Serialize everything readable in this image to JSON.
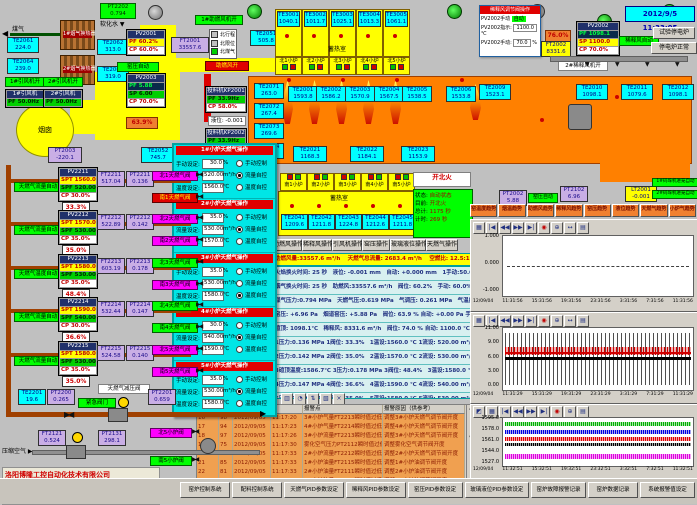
{
  "header": {
    "datetime": "2012/9/5 11:33:05"
  },
  "left": {
    "coal_gas": "煤气",
    "soft_water": "软化水",
    "chimney": "烟囱",
    "comb_air_on": "助燃风开",
    "fan1_on": "1#引风机开",
    "fan2_on": "2#引风机开",
    "comb_fan_on": "1#助燃风机开",
    "dilution_fan_on": "2#稀释风机开",
    "hx": [
      "1#烟气换热器",
      "2#烟气换热器"
    ],
    "legend": [
      "北行程",
      "北限位",
      "北煤气"
    ],
    "boxes": {
      "pt2202": {
        "id": "PT2202",
        "v": "0.794"
      },
      "te2061": {
        "id": "TE2061",
        "v": "224.0"
      },
      "te2064": {
        "id": "TE2064",
        "v": "239.0"
      },
      "te2062": {
        "id": "TE2062",
        "v": "313.0"
      },
      "te2063": {
        "id": "TE2063",
        "v": "319.0"
      },
      "pt2003": {
        "id": "PT2003",
        "v": "-220.1"
      },
      "te2052": {
        "id": "TE2052",
        "v": "745.7"
      },
      "ft2001": {
        "id": "FT2001",
        "v": "33557.6"
      },
      "te2051": {
        "id": "TE2051",
        "v": "505.8"
      }
    },
    "fans": [
      {
        "label": "1#引风机",
        "pf": "PF 50.0Hz"
      },
      {
        "label": "2#引风机",
        "pf": "PF 50.0Hz"
      }
    ],
    "pv2001": {
      "id": "PV2001",
      "pf": "PF 60.2%",
      "cp": "CP 60.0%"
    },
    "pv2003": {
      "id": "PV2003",
      "pf": "PF 5.88",
      "sp": "SP 6.00",
      "cp": "CP 70.0%"
    },
    "kiln_auto": "窑压自动",
    "damper_pos": "63.9%",
    "chargers": [
      {
        "title": "投料机KP2001",
        "pf": "PF 33.9Hz",
        "cp": "CP 58.0%"
      },
      {
        "title": "投料机KP2002",
        "pf": "PF 33.9Hz",
        "cp": "CP 58.0%"
      }
    ],
    "level_box": "液位: -0.001"
  },
  "regen": {
    "room": "蓄热室",
    "units": [
      {
        "id": "TE3001",
        "v": "1040.1",
        "port": "北1小炉"
      },
      {
        "id": "TE3002",
        "v": "1011.7",
        "port": "北2小炉"
      },
      {
        "id": "TE3003",
        "v": "1025.1",
        "port": "北3小炉"
      },
      {
        "id": "TE3004",
        "v": "1013.3",
        "port": "北4小炉"
      },
      {
        "id": "TE3005",
        "v": "1061.1",
        "port": "北5小炉"
      }
    ]
  },
  "furnace": {
    "left_te": [
      {
        "id": "TE2071",
        "v": "263.0"
      },
      {
        "id": "TE2072",
        "v": "267.4"
      },
      {
        "id": "TE2073",
        "v": "269.6"
      },
      {
        "id": "TE2074",
        "v": "268.6"
      }
    ],
    "top_te": [
      {
        "id": "TE2001",
        "v": "1593.8"
      },
      {
        "id": "TE2002",
        "v": "1586.2"
      },
      {
        "id": "TE2003",
        "v": "1570.9"
      },
      {
        "id": "TE2004",
        "v": "1567.5"
      },
      {
        "id": "TE2005",
        "v": "1538.5"
      },
      {
        "id": "TE2006",
        "v": "1533.8"
      }
    ],
    "mid_te": [
      {
        "id": "TE2021",
        "v": "1168.3"
      },
      {
        "id": "TE2022",
        "v": "1184.1"
      },
      {
        "id": "TE2023",
        "v": "1153.9"
      }
    ],
    "right_te": [
      {
        "id": "TE2009",
        "v": "1523.1"
      },
      {
        "id": "TE2010",
        "v": "1098.1"
      },
      {
        "id": "TE2011",
        "v": "1079.6"
      },
      {
        "id": "TE2012",
        "v": "1098.1"
      }
    ]
  },
  "south": {
    "room": "蓄热室",
    "ports": [
      "南1小炉",
      "南2小炉",
      "南3小炉",
      "南4小炉",
      "南5小炉"
    ],
    "te": [
      {
        "id": "TE2041",
        "v": "1209.6"
      },
      {
        "id": "TE2042",
        "v": "1211.8"
      },
      {
        "id": "TE2043",
        "v": "1224.8"
      },
      {
        "id": "TE2044",
        "v": "1212.6"
      },
      {
        "id": "TE2045",
        "v": "1211.8"
      }
    ]
  },
  "fire": {
    "cmd": "开北火",
    "rows": [
      {
        "k": "状态:",
        "v": "自动状态"
      },
      {
        "k": "目前:",
        "v": "开北火"
      },
      {
        "k": "总计:",
        "v": "1175 秒"
      },
      {
        "k": "计时:",
        "v": "269 秒"
      }
    ]
  },
  "ops": [
    "助燃风操作",
    "稀释风操作",
    "引风机操作",
    "窑压操作",
    "玻璃液位操作",
    "天燃气操作"
  ],
  "info_bar": "助燃风量:33557.6 m³/h　 天燃气总流量: 2683.4 m³/h　 空燃比: 12.5:1　 气累积量: 134057.7m³",
  "params": [
    "火焰换火时间: 25 秒　液位: -0.001 mm　自动: +0.000 mm　1手动:50.0% 自动  2手动:50.0% 自动",
    "烟气换火时间: 25 秒　助燃风:33557.6 m³/h　阀位: 60.2%　手动: 60.0%",
    "煤气压力:0.794 MPa　天燃气压:0.619 MPa　气调压: 0.261 MPa　气温度: 19.6℃",
    "窑压: +6.96 Pa　烟道窑压: +5.88 Pa　阀位: 63.9 %  自动: +0.00 Pa  手动: 70.0%  自动",
    "碹顶: 1098.1℃　稀释风: 8331.6 m³/h　阀位: 74.0 %  自动: 1100.0 ℃  手动: 70.0%  自动",
    "1压力:0.136 MPa  1阀位: 33.3%　1温设:1560.0 ℃  1流设: 520.00 m³/h  1手动: 30.0%  流控",
    "2压力:0.142 MPa  2阀位: 35.0%　2温设:1570.0 ℃  2流设: 530.00 m³/h  2手动: 35.0%  流控",
    "3碹顶温度:1586.7℃  3压力:0.178 MPa  3阀位: 48.4%　3温设:1580.0 ℃  3流设: 530.00 m³/h  3手动: 35.0%  温控",
    "4压力:0.147 MPa  4阀位: 36.6%　4温设:1590.0 ℃  4流设: 540.00 m³/h  4手动: 30.0%  流控",
    "5压力:0.140 MPa  5阀位: 35.0%　5温设:1580.0 ℃  5流设: 530.00 m³/h  5手动: 35.0%  流控"
  ],
  "popup": {
    "labels": {
      "manual": "手动设定:",
      "flow": "流量设定:",
      "temp": "温度设定:"
    },
    "units": {
      "manual": "%",
      "flow": "m³/h",
      "temp": "℃"
    },
    "options": [
      "手动控制",
      "流量自控",
      "温度自控"
    ],
    "sections": [
      {
        "title": "1#小炉天燃气操作",
        "manual": "30.0",
        "flow": "520.00",
        "temp": "1560.0"
      },
      {
        "title": "2#小炉天燃气操作",
        "manual": "35.0",
        "flow": "530.00",
        "temp": "1570.0"
      },
      {
        "title": "3#小炉天燃气操作",
        "manual": "35.0",
        "flow": "530.00",
        "temp": "1580.0"
      },
      {
        "title": "4#小炉天燃气操作",
        "manual": "30.0",
        "flow": "540.00",
        "temp": "1590.0"
      },
      {
        "title": "5#小炉天燃气操作",
        "manual": "35.0",
        "flow": "530.00",
        "temp": "1580.0"
      }
    ]
  },
  "dilution": {
    "title": "稀释风调节阀操作",
    "mode_label": "PV2002手动",
    "mode": "自动",
    "r1k": "PV2002指示:",
    "r1v": "1100.0",
    "r1u": "℃",
    "r2k": "PV2002手动:",
    "r2v": "70.0",
    "r2u": "%",
    "valve": "76.0%",
    "ft2002": {
      "id": "FT2002",
      "v": "8331.6"
    },
    "pv2002": {
      "id": "PV2002",
      "pf": "PF 1098.1",
      "sp": "SP 1100.0",
      "cp": "CP 70.0%"
    },
    "auto": "稀释风自动",
    "btn1": "试验停电炉",
    "btn2": "停电炉正常"
  },
  "right_mid": {
    "pt2002": {
      "id": "PT2002",
      "v": "5.88"
    },
    "pt2102": {
      "id": "PT2102",
      "v": "6.96"
    },
    "lt2001": {
      "id": "LT2001",
      "v": "-0.001"
    },
    "kiln_auto": "窑压自动",
    "stacker1": "1#码垛机进笼自动",
    "stacker2": "2#码垛机进笼自动"
  },
  "trend_buttons": [
    "窑温度趋势",
    "烟温趋势",
    "助燃风趋势",
    "稀释风趋势",
    "窑压趋势",
    "液位趋势",
    "天燃气趋势",
    "小炉气趋势"
  ],
  "charts": [
    {
      "yticks": [
        "1.000",
        "0.000",
        "-1.000"
      ],
      "xticks": [
        "12/09/04",
        "11:31:56",
        "15:31:56",
        "19:31:56",
        "23:31:56",
        "3:31:56",
        "7:31:56",
        "11:31:56"
      ]
    },
    {
      "yticks": [
        "11.00",
        "9.00",
        "6.00",
        "3.00",
        "0.00"
      ],
      "xticks": [
        "12/09/04",
        "11:31:29",
        "15:31:29",
        "19:31:29",
        "23:31:29",
        "3:31:29",
        "7:31:29",
        "11:31:29"
      ]
    },
    {
      "yticks": [
        "1595.0",
        "1578.0",
        "1561.0",
        "1544.0",
        "1527.0"
      ],
      "xticks": [
        "12/09/04",
        "11:32:51",
        "15:32:51",
        "19:32:51",
        "23:32:51",
        "3:32:51",
        "7:32:51",
        "11:32:51"
      ]
    }
  ],
  "trains": [
    {
      "auto": "天燃气流量自动",
      "pv": {
        "id": "PV2211",
        "spt": "SPT 1560.0",
        "spf": "SPF 520.00",
        "cp": "CP 30.0%"
      },
      "ft": {
        "id": "FT2211",
        "v": "517.04"
      },
      "pt": {
        "id": "PT2211",
        "v": "0.136"
      },
      "pos": "33.3%",
      "vn": "北1天燃气阀",
      "vs": "南1天燃气阀"
    },
    {
      "auto": "天燃气流量自动",
      "pv": {
        "id": "PV2212",
        "spt": "SPT 1570.0",
        "spf": "SPF 530.00",
        "cp": "CP 35.0%"
      },
      "ft": {
        "id": "FT2212",
        "v": "522.89"
      },
      "pt": {
        "id": "PT2212",
        "v": "0.142"
      },
      "pos": "35.0%",
      "vn": "北2天燃气阀",
      "vs": "南2天燃气阀"
    },
    {
      "auto": "天燃气温度自动",
      "pv": {
        "id": "PV2213",
        "spt": "SPT 1580.0",
        "spf": "SPF 530.00",
        "cp": "CP 35.0%"
      },
      "ft": {
        "id": "FT2213",
        "v": "603.19"
      },
      "pt": {
        "id": "PT2213",
        "v": "0.178"
      },
      "pos": "48.4%",
      "vn": "北3天燃气阀",
      "vs": "南3天燃气阀"
    },
    {
      "auto": "天燃气流量自动",
      "pv": {
        "id": "PV2214",
        "spt": "SPT 1590.0",
        "spf": "SPF 540.00",
        "cp": "CP 30.0%"
      },
      "ft": {
        "id": "FT2214",
        "v": "532.44"
      },
      "pt": {
        "id": "PT2214",
        "v": "0.147"
      },
      "pos": "36.6%",
      "vn": "北4天燃气阀",
      "vs": "南4天燃气阀"
    },
    {
      "auto": "天燃气流量自动",
      "pv": {
        "id": "PV2215",
        "spt": "SPT 1580.0",
        "spf": "SPF 530.00",
        "cp": "CP 35.0%"
      },
      "ft": {
        "id": "FT2215",
        "v": "524.58"
      },
      "pt": {
        "id": "PT2215",
        "v": "0.140"
      },
      "pos": "35.0%",
      "vn": "北5天燃气阀",
      "vs": "南5天燃气阀"
    }
  ],
  "gas_bottom": {
    "te2201": {
      "id": "TE2201",
      "v": "19.6"
    },
    "pt2200": {
      "id": "PT2200",
      "v": "0.265"
    },
    "emerg": "紧急阀门",
    "reducer": "天燃气减压阀",
    "pt2201": {
      "id": "PT2201",
      "v": "0.659"
    }
  },
  "air": {
    "label": "压缩空气",
    "ft2121": {
      "id": "FT2121",
      "v": "0.524"
    },
    "pt2131": {
      "id": "PT2131",
      "v": "298.1"
    },
    "vn": "北5小炉阀",
    "vs": "南5小炉阀"
  },
  "company": {
    "name": "洛阳博隆工控自动化技术有限公司",
    "phone": "技术服务电话: 0379-65105029  13525974529",
    "web": "技术服务网址: www.chinabolong.com"
  },
  "alarms": {
    "headers": [
      "报警点",
      "报警原因（供参考）"
    ],
    "rows": [
      {
        "n": "16",
        "code": "98",
        "date": "2012/09/05",
        "time": "11:17:20",
        "point": "3#小炉气量FT2213瞬时值过低",
        "reason": "调整3#小炉天燃气调节阀开度"
      },
      {
        "n": "17",
        "code": "94",
        "date": "2012/09/05",
        "time": "11:17:23",
        "point": "4#小炉气量FT2214瞬时值过低",
        "reason": "调整4#小炉天燃气调节阀开度"
      },
      {
        "n": "18",
        "code": "97",
        "date": "2012/09/05",
        "time": "11:17:26",
        "point": "3#小炉流量FT2213瞬时值过低",
        "reason": "调整3#小炉天燃气调节阀开度"
      },
      {
        "n": "19",
        "code": "75",
        "date": "2012/09/05",
        "time": "11:17:30",
        "point": "雾化空气压力PT2112瞬时值过低",
        "reason": "调整雾化空气调节阀开度"
      },
      {
        "n": "20",
        "code": "82",
        "date": "2012/09/05",
        "time": "11:17:33",
        "point": "2#小炉流量FT2212瞬时值过低",
        "reason": "调整2#小炉天燃气调节阀开度"
      },
      {
        "n": "21",
        "code": "85",
        "date": "2012/09/05",
        "time": "11:17:33",
        "point": "1#小炉油量FT2115瞬时值过低",
        "reason": "调整1#小炉油调节阀开度"
      },
      {
        "n": "22",
        "code": "81",
        "date": "2012/09/05",
        "time": "11:17:33",
        "point": "2#小炉油量FT2111瞬时值过低",
        "reason": "调整2#小炉油调节阀开度"
      },
      {
        "n": "23",
        "code": "83",
        "date": "2012/09/05",
        "time": "11:17:33",
        "point": "1#小炉油量FT2113瞬时值过低",
        "reason": "调整1#小炉油调节阀开度"
      }
    ]
  },
  "footer": [
    "窑炉控制系统",
    "配料控制系统",
    "天燃气PID参数设定",
    "稀释风PID参数设定",
    "窑压PID参数设定",
    "玻璃液位PID参数设定",
    "窑炉故障报警记录",
    "窑炉数据记录",
    "系统报警值设定"
  ]
}
